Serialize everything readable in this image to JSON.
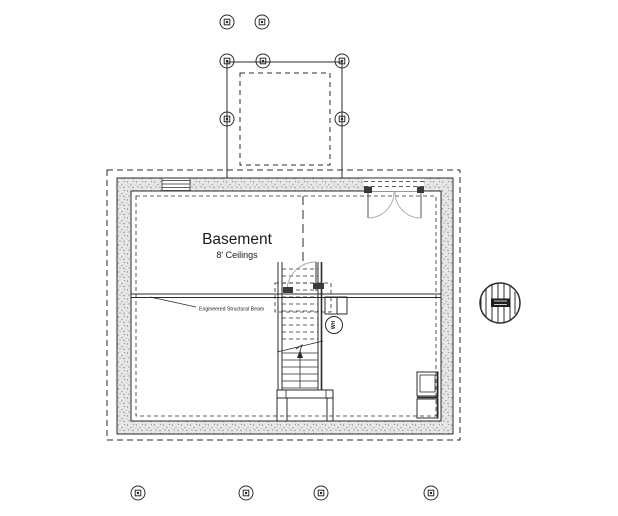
{
  "floor_plan": {
    "room_label": "Basement",
    "room_sublabel": "8' Ceilings",
    "beam_annotation": "Engineered Structural Beam",
    "water_heater_label": "WH",
    "colors": {
      "background": "#ffffff",
      "line": "#2b2b2b",
      "swing_arc": "#a9a9a9",
      "wall_fill": "#e7e7e7",
      "wall_speckle": "#8f8f8f"
    },
    "icons": {
      "pier_marker": "circle-with-square concrete pier/footing symbol",
      "water_heater": "small circle with rotated WH label",
      "post_detail": "circle with vertical plank hatch and dark reference tag"
    },
    "pier_markers": [
      {
        "x": 227,
        "y": 22
      },
      {
        "x": 262,
        "y": 22
      },
      {
        "x": 227,
        "y": 61
      },
      {
        "x": 263,
        "y": 61
      },
      {
        "x": 342,
        "y": 61
      },
      {
        "x": 227,
        "y": 119
      },
      {
        "x": 342,
        "y": 119
      },
      {
        "x": 138,
        "y": 493
      },
      {
        "x": 246,
        "y": 493
      },
      {
        "x": 321,
        "y": 493
      },
      {
        "x": 431,
        "y": 493
      }
    ]
  }
}
